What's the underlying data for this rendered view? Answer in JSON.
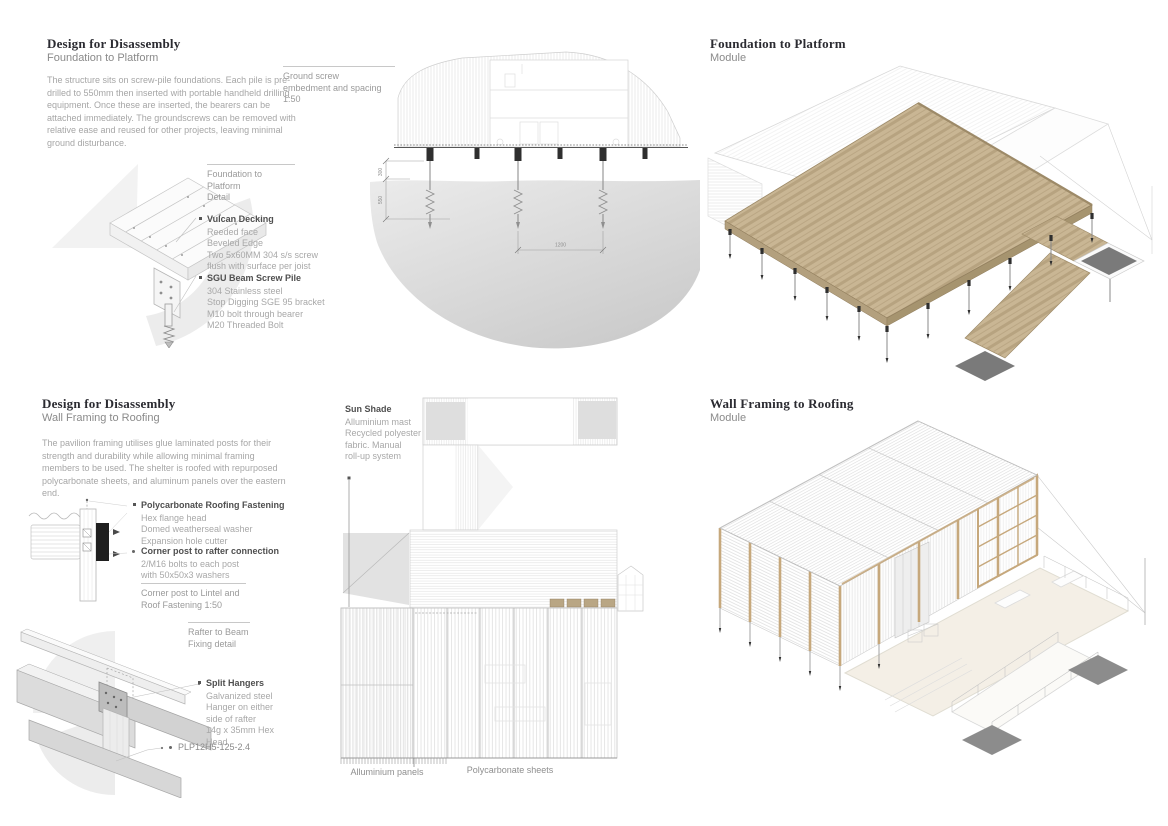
{
  "colors": {
    "heading": "#2b2b31",
    "subheading": "#8a8a8a",
    "body_text": "#a6a6a6",
    "label_title": "#4f4f4f",
    "label_text": "#a8a8a8",
    "caption_text": "#9a9a9a",
    "rule": "#c8c8c8",
    "deck_wood": "#c9b694",
    "deck_wood_dark": "#a8936f",
    "timber": "#c6a87c",
    "ground_shade": "#d8d8d8",
    "mat_gray": "#7a7a7a",
    "deck_cream": "#f4efe6",
    "drawing_line": "#c4c4c4",
    "pile_dark": "#2f2f2f"
  },
  "panels": {
    "foundation": {
      "heading": "Design for Disassembly",
      "subheading": "Foundation to Platform",
      "body": "The structure sits on screw-pile foundations. Each pile is pre-drilled to 550mm then inserted with portable handheld drilling equipment. Once these are inserted, the bearers can be attached immediately. The groundscrews can be removed with relative ease and reused for other projects, leaving minimal ground disturbance.",
      "section_caption": {
        "line1": "Ground screw",
        "line2": "embedment and spacing",
        "line3": "1:50"
      },
      "detail_caption": {
        "line1": "Foundation to Platform",
        "line2": "Detail"
      },
      "legend": [
        {
          "title": "Vulcan Decking",
          "lines": [
            "Reeded face",
            "Beveled Edge",
            "Two 5x60MM 304 s/s screw",
            "flush with surface per joist"
          ]
        },
        {
          "title": "SGU Beam Screw Pile",
          "lines": [
            "304 Stainless steel",
            "Stop Digging SGE 95 bracket",
            "M10 bolt through bearer",
            "M20 Threaded Bolt"
          ]
        }
      ],
      "dims": {
        "upper": "300",
        "embed": "550",
        "spacing": "1200"
      }
    },
    "foundation_module": {
      "heading": "Foundation to Platform",
      "subheading": "Module"
    },
    "roofing": {
      "heading": "Design for Disassembly",
      "subheading": "Wall Framing to Roofing",
      "body": "The pavilion framing utilises glue laminated posts for their strength and durability while allowing minimal framing members to be used. The shelter is roofed with repurposed polycarbonate sheets, and aluminum panels over the eastern end.",
      "legend": [
        {
          "title": "Polycarbonate Roofing Fastening",
          "lines": [
            "Hex flange head",
            "Domed weatherseal washer",
            "Expansion hole cutter"
          ]
        },
        {
          "title": "Corner post to rafter connection",
          "lines": [
            "2/M16 bolts to each post",
            "with 50x50x3 washers"
          ]
        }
      ],
      "fastening_caption": {
        "line1": "Corner post to Lintel and",
        "line2": "Roof Fastening 1:50"
      },
      "rafter_caption": {
        "line1": "Rafter to Beam",
        "line2": "Fixing detail"
      },
      "split_hangers": {
        "title": "Split Hangers",
        "lines": [
          "Galvanized steel",
          "Hanger on either",
          "side of rafter",
          "14g x 35mm Hex",
          "Head"
        ]
      },
      "part_number": "PLP12H5-125-2.4",
      "sun_shade": {
        "title": "Sun Shade",
        "lines": [
          "Alluminium mast",
          "Recycled polyester",
          "fabric. Manual",
          "roll-up system"
        ]
      },
      "elevation_labels": {
        "left": "Alluminium panels",
        "right": "Polycarbonate sheets"
      }
    },
    "roofing_module": {
      "heading": "Wall Framing to Roofing",
      "subheading": "Module"
    }
  }
}
